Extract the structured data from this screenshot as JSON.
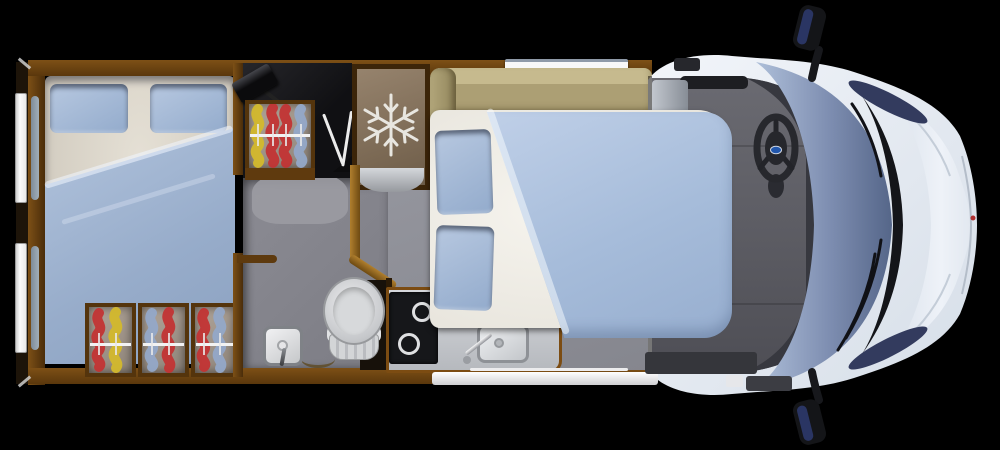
{
  "meta": {
    "app": "motorhome-floorplan-top-view",
    "view": "top-down 3D render of a motorhome layout on black background",
    "width_px": 1000,
    "height_px": 450,
    "visible_text": "none"
  },
  "colors": {
    "background": "#000000",
    "wall_wood": "#6b4211",
    "wall_wood_dark": "#3c2509",
    "gold_trim": "#b07f2e",
    "floor_gray": "#8e8f97",
    "cab_floor_gray": "#5b5b62",
    "bedding_blue": "#a6bcda",
    "pillow_blue": "#a5bad6",
    "mattress_white": "#f1efe8",
    "mattress_cream": "#d6d0c4",
    "sofa_tan": "#b4a87c",
    "fridge_door_brown": "#8a7660",
    "snowflake_white": "#e8e6e0",
    "cooktop_black": "#16171a",
    "counter_gray": "#ced1d5",
    "ceramic_white": "#e3e4e6",
    "cab_body_white": "#eaeef5",
    "windshield_blue": "#8194b4",
    "door_window_blue": "#333b5e",
    "steering_black": "#27282d",
    "brand_badge_blue": "#2257ac",
    "brand_badge_red_dot": "#b03030",
    "hanger_red": "#c23434",
    "hanger_yellow": "#d3b82c",
    "hanger_blue": "#93a8c8",
    "window_white": "#f6f6f6"
  },
  "regions": {
    "vehicle": {
      "label": "Motorhome top view floorplan"
    },
    "rear_bedroom": {
      "label": "Rear bedroom with double bed, two pillows and blue duvet"
    },
    "rear_windows": {
      "label": "Two rear side windows",
      "count": 2
    },
    "under_bed_storage": {
      "label": "Three under-bed wardrobe compartments with clothes hangers",
      "boxes": 3
    },
    "wardrobe_top": {
      "label": "Wardrobe with clothes on hangers"
    },
    "tv_unit": {
      "label": "TV on swivel bracket with antenna"
    },
    "fridge": {
      "label": "Refrigerator with freezer",
      "icon": "snowflake-icon"
    },
    "lounge": {
      "label": "Tan lounge bench seating"
    },
    "top_window": {
      "label": "Kitchen-side top window"
    },
    "overcab_cabinet": {
      "label": "Cabinet beside cab"
    },
    "main_bed": {
      "label": "Main double bed with two pillows and blue duvet"
    },
    "bathroom": {
      "label": "Bathroom with toilet and shower mixer"
    },
    "kitchen": {
      "label": "Kitchen with two-burner hob and sink"
    },
    "entry_step": {
      "label": "Entry door step"
    },
    "cab": {
      "label": "Driver cab with steering wheel, windshield, wipers and wing mirrors"
    }
  },
  "fixtures": {
    "hob_burners": 2,
    "pillows_rear_bed": 2,
    "pillows_main_bed": 2,
    "wing_mirrors": 2,
    "windshield_wipers": 2,
    "hanger_colors_top_wardrobe": [
      "yellow",
      "red",
      "red",
      "blue"
    ],
    "hanger_colors_under_bed": [
      [
        "red",
        "yellow"
      ],
      [
        "blue",
        "red"
      ],
      [
        "red",
        "blue"
      ]
    ],
    "icons": {
      "snowflake-icon": "fridge / freezer symbol",
      "toilet-icon": "toilet bowl seen from above",
      "shower-mixer-icon": "square shower tap with handle",
      "hanger-icon": "clothes bunched on hanger rail",
      "steering-wheel-icon": "steering wheel with blue oval badge",
      "wing-mirror-icon": "exterior side mirror",
      "tv-icon": "flat TV on swivel arm",
      "burner-icon": "gas/ceramic hob ring"
    }
  }
}
